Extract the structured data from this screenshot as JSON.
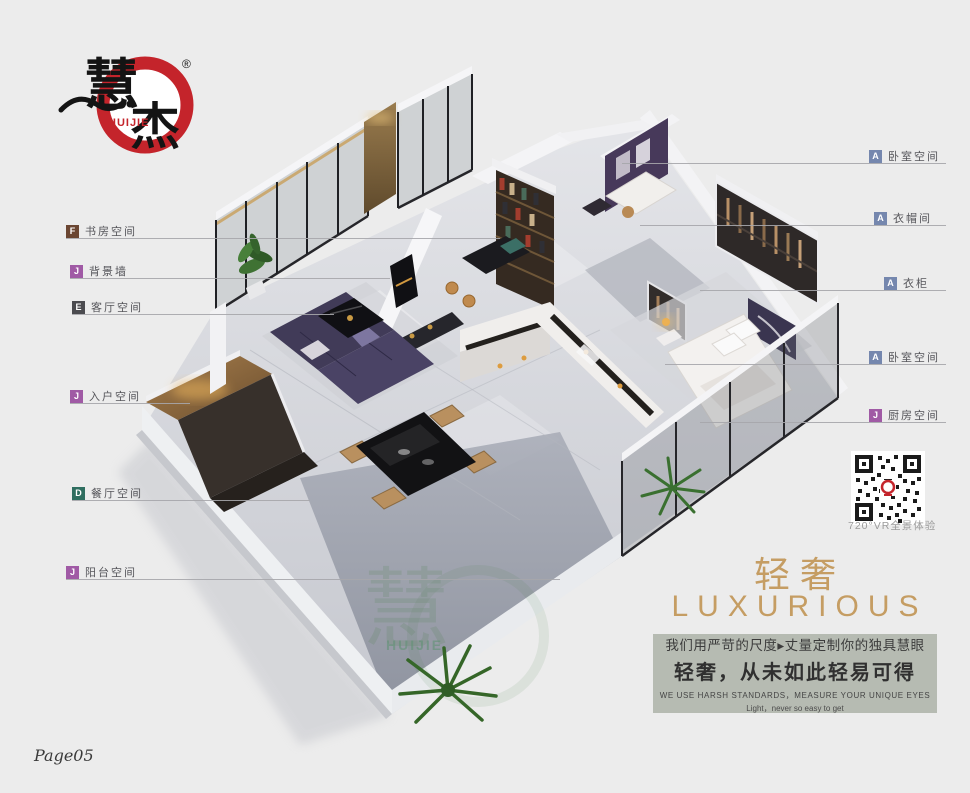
{
  "page": {
    "background": "#ececec",
    "page_number": "Page05"
  },
  "logo": {
    "brand_char1": "慧",
    "brand_char2": "杰",
    "brand_en": "HUIJIE",
    "registered": "®",
    "ring_color": "#c4242b"
  },
  "callouts": {
    "left": [
      {
        "letter": "F",
        "label": "书房空间",
        "color": "#6b4632"
      },
      {
        "letter": "J",
        "label": "背景墙",
        "color": "#a05aa5"
      },
      {
        "letter": "E",
        "label": "客厅空间",
        "color": "#4b4b4f"
      },
      {
        "letter": "J",
        "label": "入户空间",
        "color": "#a05aa5"
      },
      {
        "letter": "D",
        "label": "餐厅空间",
        "color": "#2f6e60"
      },
      {
        "letter": "J",
        "label": "阳台空间",
        "color": "#a05aa5"
      }
    ],
    "right": [
      {
        "letter": "A",
        "label": "卧室空间",
        "color": "#7587ae"
      },
      {
        "letter": "A",
        "label": "衣帽间",
        "color": "#7587ae"
      },
      {
        "letter": "A",
        "label": "衣柜",
        "color": "#7587ae"
      },
      {
        "letter": "A",
        "label": "卧室空间",
        "color": "#7587ae"
      },
      {
        "letter": "J",
        "label": "厨房空间",
        "color": "#a05aa5"
      }
    ]
  },
  "qr": {
    "caption": "720°VR全景体验"
  },
  "tagline": {
    "cn": "轻奢",
    "en": "LUXURIOUS",
    "color": "#c59d63"
  },
  "slogan": {
    "bg": "#b6bbb2",
    "line1": "我们用严苛的尺度▸丈量定制你的独具慧眼",
    "line2": "轻奢，从未如此轻易可得",
    "line3": "WE USE HARSH STANDARDS，MEASURE YOUR UNIQUE EYES",
    "line4": "Light，never so easy to get"
  },
  "floorplan": {
    "watermark": "HUIJIE",
    "watermark_char": "慧"
  }
}
